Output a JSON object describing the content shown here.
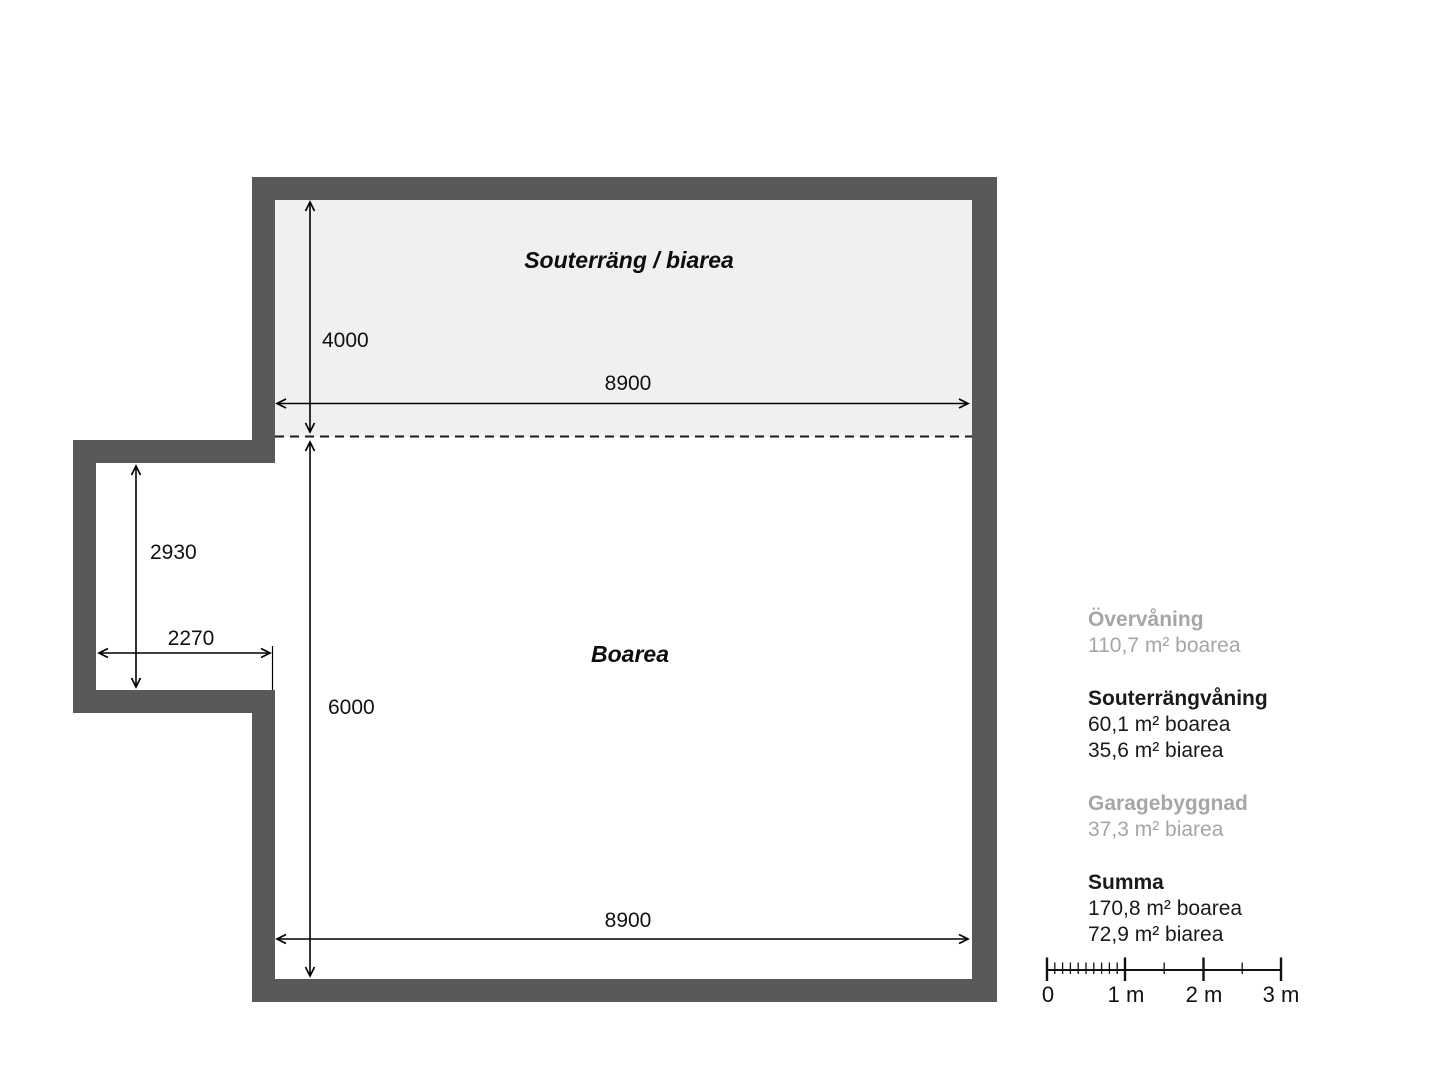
{
  "plan": {
    "labels": {
      "souterrang": "Souterräng / biarea",
      "boarea": "Boarea"
    },
    "dims": {
      "upper_height": "4000",
      "upper_width": "8900",
      "bump_height": "2930",
      "bump_width": "2270",
      "lower_height": "6000",
      "lower_width": "8900"
    }
  },
  "legend": {
    "groups": [
      {
        "title": "Övervåning",
        "lines": [
          "110,7 m² boarea"
        ]
      },
      {
        "title": "Souterrängvåning",
        "lines": [
          "60,1 m² boarea",
          "35,6 m² biarea"
        ]
      },
      {
        "title": "Garagebyggnad",
        "lines": [
          "37,3 m² biarea"
        ]
      },
      {
        "title": "Summa",
        "lines": [
          "170,8 m² boarea",
          "72,9 m² biarea"
        ]
      }
    ]
  },
  "scalebar": {
    "labels": [
      "0",
      "1 m",
      "2 m",
      "3 m"
    ]
  },
  "colors": {
    "wall": "#595959",
    "shade": "#f0f0f0",
    "muted_text": "#a6a6a6",
    "line": "#000000"
  }
}
